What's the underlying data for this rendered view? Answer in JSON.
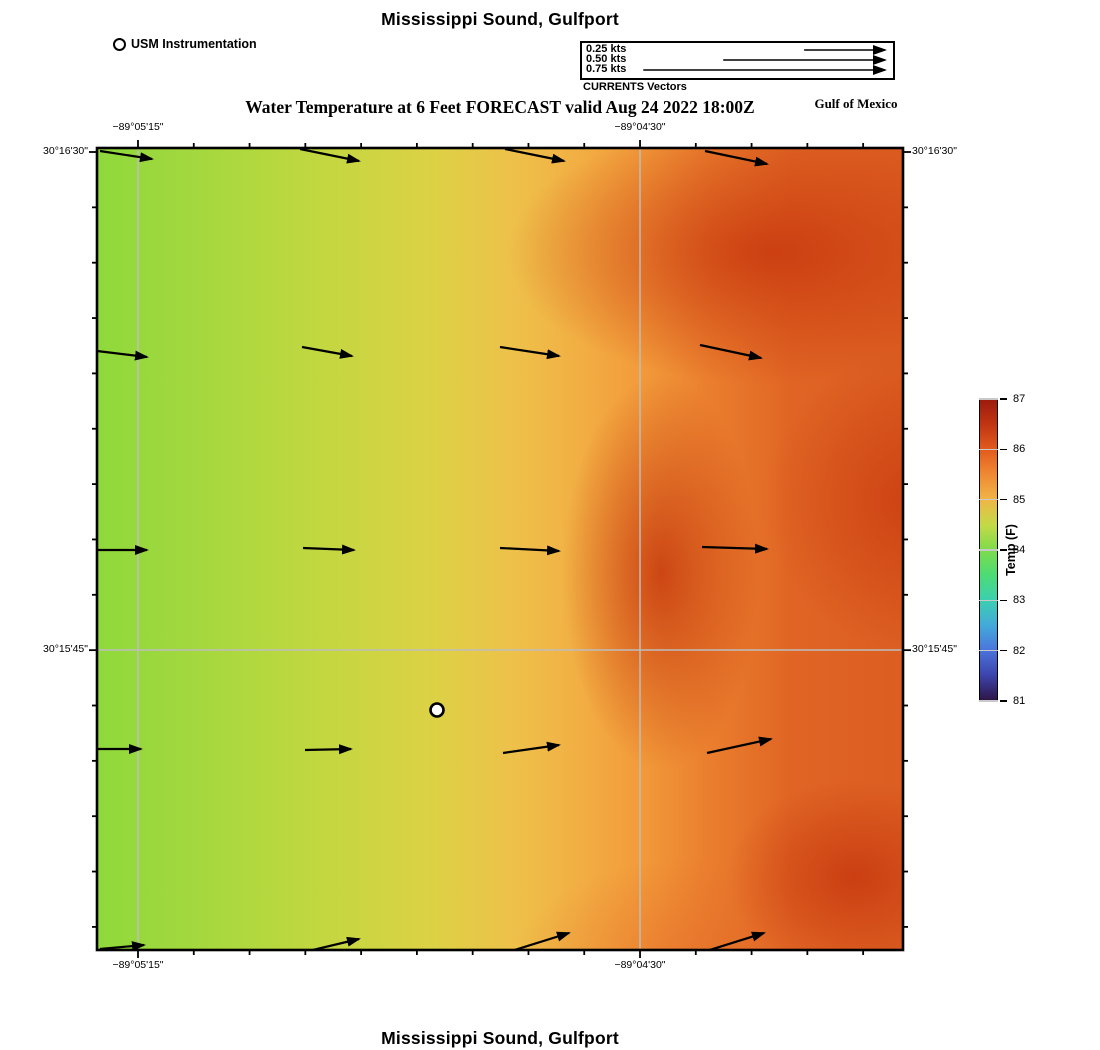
{
  "header": {
    "title": "Mississippi Sound, Gulfport",
    "instrumentation_legend": "USM Instrumentation",
    "subtitle": "Water Temperature at 6 Feet FORECAST valid Aug 24 2022 18:00Z",
    "region_label": "Gulf of Mexico",
    "vector_legend": {
      "caption": "CURRENTS Vectors",
      "entries": [
        {
          "label": "0.25 kts",
          "tail_frac": 0.714
        },
        {
          "label": "0.50 kts",
          "tail_frac": 0.454
        },
        {
          "label": "0.75 kts",
          "tail_frac": 0.197
        }
      ]
    }
  },
  "footer": {
    "title": "Mississippi Sound, Gulfport"
  },
  "colorbar": {
    "title": "Temp (F)",
    "min": 81,
    "max": 87,
    "ticks": [
      87,
      86,
      85,
      84,
      83,
      82,
      81
    ],
    "stops": [
      {
        "pos": 0.0,
        "color": "#2e1548"
      },
      {
        "pos": 0.083,
        "color": "#3d44ad"
      },
      {
        "pos": 0.167,
        "color": "#4a75dc"
      },
      {
        "pos": 0.25,
        "color": "#43aad9"
      },
      {
        "pos": 0.333,
        "color": "#3bd0b0"
      },
      {
        "pos": 0.417,
        "color": "#4cdc74"
      },
      {
        "pos": 0.5,
        "color": "#7edb4c"
      },
      {
        "pos": 0.583,
        "color": "#c4da46"
      },
      {
        "pos": 0.667,
        "color": "#f0b646"
      },
      {
        "pos": 0.75,
        "color": "#f08a33"
      },
      {
        "pos": 0.833,
        "color": "#e25c1e"
      },
      {
        "pos": 0.917,
        "color": "#c23512"
      },
      {
        "pos": 1.0,
        "color": "#9c1b0e"
      }
    ]
  },
  "axes": {
    "top": [
      {
        "label": "−89°05'15\"",
        "x": 138
      },
      {
        "label": "−89°04'30\"",
        "x": 640
      }
    ],
    "bottom": [
      {
        "label": "−89°05'15\"",
        "x": 138
      },
      {
        "label": "−89°04'30\"",
        "x": 640
      }
    ],
    "left": [
      {
        "label": "30°16'30\"",
        "y": 152
      },
      {
        "label": "30°15'45\"",
        "y": 650
      }
    ],
    "right": [
      {
        "label": "30°16'30\"",
        "y": 152
      },
      {
        "label": "30°15'45\"",
        "y": 650
      }
    ]
  },
  "chart_data": {
    "type": "heatmap",
    "title": "Mississippi Sound, Gulfport",
    "subtitle": "Water Temperature at 6 Feet FORECAST valid Aug 24 2022 18:00Z",
    "colorbar_label": "Temp (F)",
    "colorbar_range": [
      81,
      87
    ],
    "colorbar_ticks": [
      81,
      82,
      83,
      84,
      85,
      86,
      87
    ],
    "x_axis_labels": [
      "−89°05'15\"",
      "−89°04'30\""
    ],
    "y_axis_labels": [
      "30°16'30\"",
      "30°15'45\""
    ],
    "temperature_field_f_approx": {
      "note": "values estimated from color field vs colorbar, west to east columns",
      "lon_frac": [
        0.03,
        0.28,
        0.53,
        0.79,
        1.0
      ],
      "rows_north_to_south": [
        [
          84.2,
          84.6,
          85.2,
          86.3,
          86.2
        ],
        [
          84.2,
          84.5,
          85.1,
          86.4,
          86.3
        ],
        [
          84.2,
          84.5,
          85.3,
          86.4,
          86.2
        ],
        [
          84.3,
          84.7,
          85.2,
          86.3,
          86.1
        ],
        [
          84.3,
          84.8,
          85.1,
          85.8,
          86.3
        ]
      ]
    },
    "station": {
      "name": "USM Instrumentation",
      "x": 340,
      "y": 562
    },
    "current_vectors_px": {
      "note": "map-local pixel segments [x1,y1,x2,y2]; legend scale ~82 px per 0.25 kts, flow ~eastward",
      "segments": [
        [
          3,
          3,
          55,
          11
        ],
        [
          203,
          1,
          262,
          13
        ],
        [
          408,
          1,
          467,
          13
        ],
        [
          608,
          3,
          670,
          16
        ],
        [
          0,
          203,
          50,
          209
        ],
        [
          205,
          199,
          255,
          208
        ],
        [
          403,
          199,
          462,
          208
        ],
        [
          603,
          197,
          664,
          210
        ],
        [
          0,
          402,
          50,
          402
        ],
        [
          206,
          400,
          257,
          402
        ],
        [
          403,
          400,
          462,
          403
        ],
        [
          605,
          399,
          670,
          401
        ],
        [
          0,
          601,
          44,
          601
        ],
        [
          208,
          602,
          254,
          601
        ],
        [
          406,
          605,
          462,
          597
        ],
        [
          610,
          605,
          674,
          591
        ],
        [
          3,
          801,
          47,
          797
        ],
        [
          203,
          805,
          262,
          791
        ],
        [
          408,
          805,
          472,
          785
        ],
        [
          603,
          805,
          667,
          785
        ]
      ]
    }
  }
}
